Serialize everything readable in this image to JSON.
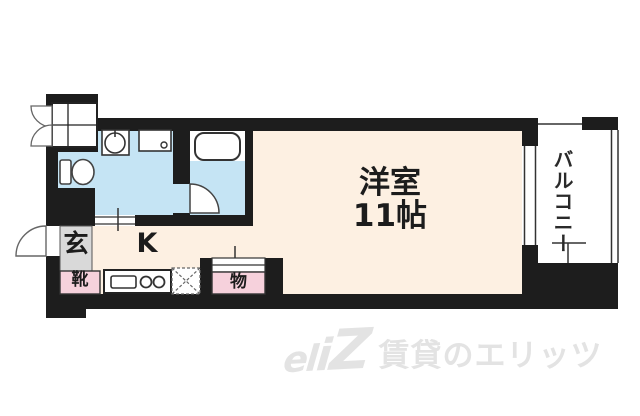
{
  "floorplan": {
    "type": "japanese-apartment-floor-plan",
    "rooms": {
      "main_room": {
        "name": "洋室",
        "size": "11帖"
      },
      "kitchen": {
        "label": "K"
      },
      "entrance": {
        "label": "玄"
      },
      "shoe_cabinet": {
        "label": "靴"
      },
      "closet": {
        "label": "物"
      },
      "balcony": {
        "label": "バルコニー"
      }
    },
    "fixtures": [
      "meter-box",
      "toilet",
      "washbasin-sink",
      "washing-machine-space",
      "bathtub",
      "kitchen-sink",
      "two-burner-stove",
      "refrigerator-space",
      "entrance-door",
      "bathroom-door",
      "sliding-window",
      "closet-sliding-door"
    ],
    "colors": {
      "wall": "#1d1d1d",
      "room_floor": "#fdf0e2",
      "wet_area_floor": "#c5e4f4",
      "storage_fill": "#f6d1dc",
      "entrance_fill": "#d9d9d9",
      "fixture_outline": "#333333",
      "watermark": "#e3e3e3"
    }
  },
  "watermark": {
    "logo_text": "eliZ",
    "logo_part1": "el",
    "logo_part2": "i",
    "logo_part3": "Z",
    "brand_text": "賃貸のエリッツ"
  }
}
